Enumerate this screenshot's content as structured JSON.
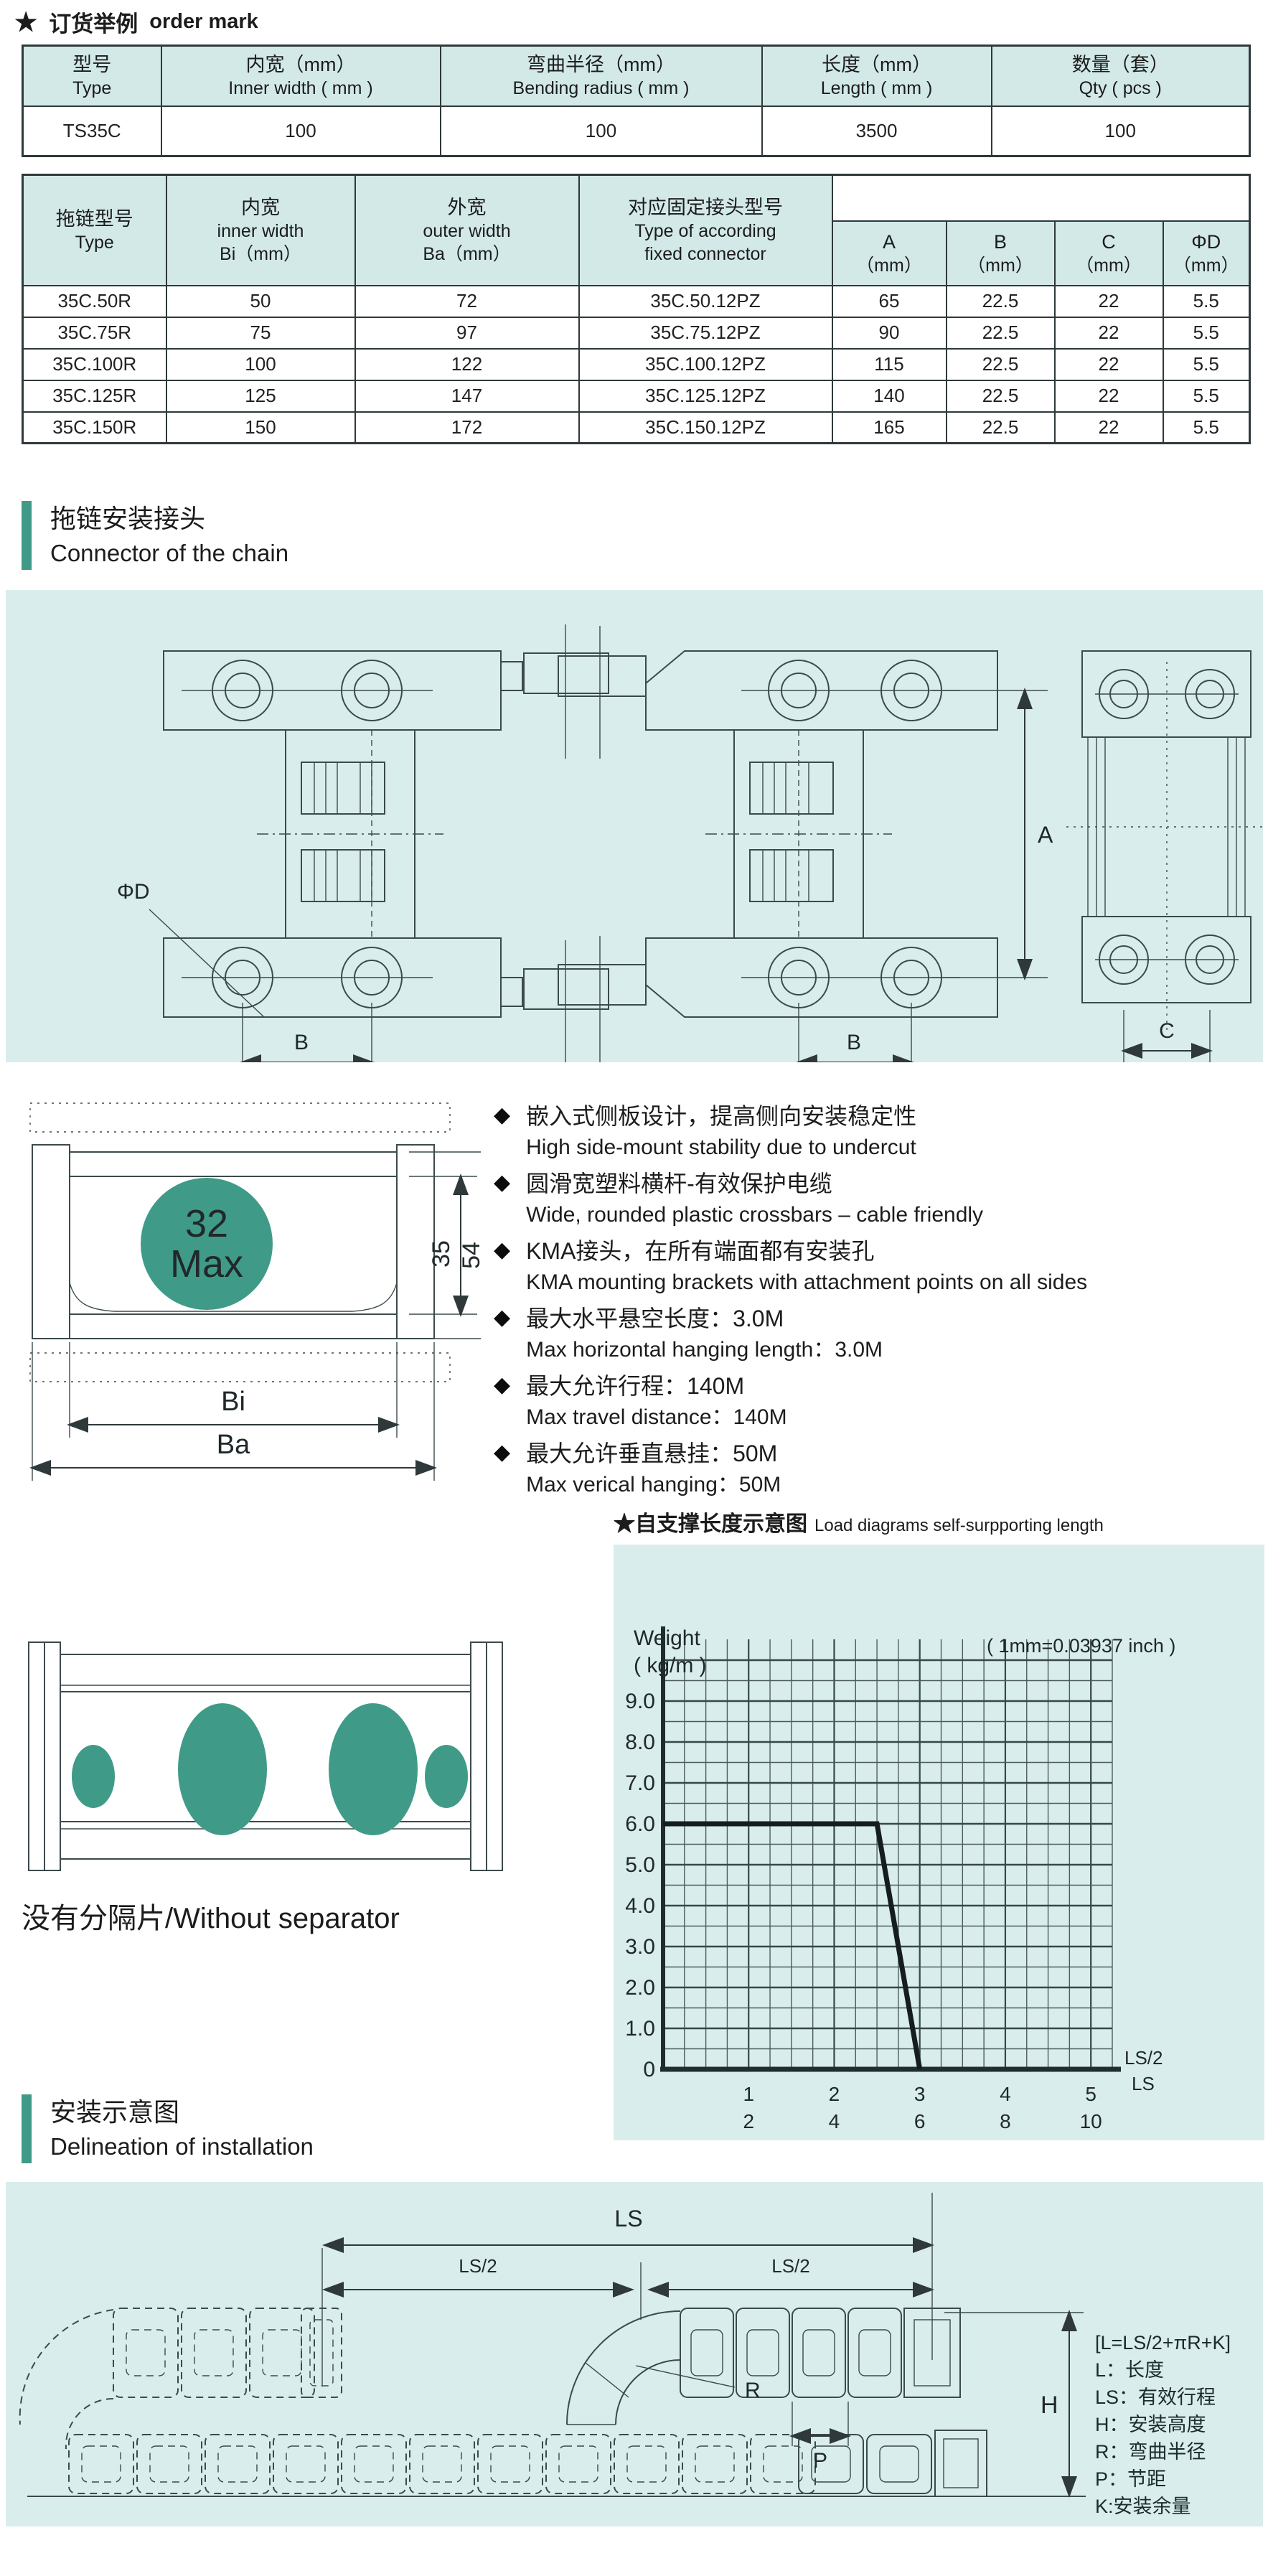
{
  "order": {
    "star": "★",
    "title_zh": "订货举例",
    "title_en": "order mark",
    "headers": [
      {
        "zh": "型号",
        "en": "Type"
      },
      {
        "zh": "内宽（mm）",
        "en": "Inner width ( mm )"
      },
      {
        "zh": "弯曲半径（mm）",
        "en": "Bending radius ( mm )"
      },
      {
        "zh": "长度（mm）",
        "en": "Length ( mm )"
      },
      {
        "zh": "数量（套）",
        "en": "Qty ( pcs )"
      }
    ],
    "rows": [
      [
        "TS35C",
        "100",
        "100",
        "3500",
        "100"
      ]
    ]
  },
  "spec": {
    "col1": {
      "zh": "拖链型号",
      "en": "Type"
    },
    "col2": {
      "zh": "内宽",
      "en": "inner width",
      "sub": "Bi（mm）"
    },
    "col3": {
      "zh": "外宽",
      "en": "outer width",
      "sub": "Ba（mm）"
    },
    "col4": {
      "zh": "对应固定接头型号",
      "en1": "Type of according",
      "en2": "fixed connector"
    },
    "dims": [
      {
        "name": "A",
        "unit": "（mm）"
      },
      {
        "name": "B",
        "unit": "（mm）"
      },
      {
        "name": "C",
        "unit": "（mm）"
      },
      {
        "name": "ΦD",
        "unit": "（mm）"
      }
    ],
    "rows": [
      [
        "35C.50R",
        "50",
        "72",
        "35C.50.12PZ",
        "65",
        "22.5",
        "22",
        "5.5"
      ],
      [
        "35C.75R",
        "75",
        "97",
        "35C.75.12PZ",
        "90",
        "22.5",
        "22",
        "5.5"
      ],
      [
        "35C.100R",
        "100",
        "122",
        "35C.100.12PZ",
        "115",
        "22.5",
        "22",
        "5.5"
      ],
      [
        "35C.125R",
        "125",
        "147",
        "35C.125.12PZ",
        "140",
        "22.5",
        "22",
        "5.5"
      ],
      [
        "35C.150R",
        "150",
        "172",
        "35C.150.12PZ",
        "165",
        "22.5",
        "22",
        "5.5"
      ]
    ]
  },
  "connector": {
    "title_zh": "拖链安装接头",
    "title_en": "Connector of the chain",
    "labels": {
      "phi_d": "ΦD",
      "b_left": "B",
      "a": "A",
      "b_mid": "B",
      "c": "C"
    }
  },
  "cross_section": {
    "circle_top": "32",
    "circle_bottom": "Max",
    "inner_height": "35",
    "outer_height": "54",
    "bi": "Bi",
    "ba": "Ba"
  },
  "features": {
    "items": [
      {
        "zh": "嵌入式侧板设计，提高侧向安装稳定性",
        "en": "High side-mount stability due to undercut"
      },
      {
        "zh": "圆滑宽塑料横杆-有效保护电缆",
        "en": "Wide, rounded plastic crossbars – cable friendly"
      },
      {
        "zh": "KMA接头，在所有端面都有安装孔",
        "en": "KMA mounting brackets with attachment points on all sides"
      },
      {
        "zh": "最大水平悬空长度：3.0M",
        "en": "Max horizontal hanging length：3.0M"
      },
      {
        "zh": "最大允许行程：140M",
        "en": "Max travel distance：140M"
      },
      {
        "zh": "最大允许垂直悬挂：50M",
        "en": "Max verical hanging：50M"
      }
    ],
    "bullet": "◆"
  },
  "chart_header": {
    "star": "★",
    "zh": "自支撑长度示意图",
    "en": "Load diagrams self-surpporting length"
  },
  "chart_data": {
    "type": "line",
    "title": "自支撑长度示意图 / Load diagrams self-surpporting length",
    "ylabel_lines": [
      "Weight",
      "( kg/m )"
    ],
    "note": "( 1mm=0.03937 inch )",
    "x_axis_label_top": "LS/2",
    "x_axis_label_bottom": "LS",
    "x_ticks": [
      {
        "ls2": "1",
        "ls": "2",
        "x": 1
      },
      {
        "ls2": "2",
        "ls": "4",
        "x": 2
      },
      {
        "ls2": "3",
        "ls": "6",
        "x": 3
      },
      {
        "ls2": "4",
        "ls": "8",
        "x": 4
      },
      {
        "ls2": "5",
        "ls": "10",
        "x": 5
      }
    ],
    "x_max": 5.25,
    "x_minor_step": 0.25,
    "y_ticks": [
      0,
      1,
      2,
      3,
      4,
      5,
      6,
      7,
      8,
      9
    ],
    "y_max": 10.25,
    "y_minor_step": 0.5,
    "grid": true,
    "legend_position": "none",
    "series": [
      {
        "name": "self-supporting load limit",
        "points": [
          [
            0,
            6.0
          ],
          [
            2.5,
            6.0
          ],
          [
            3.0,
            0
          ]
        ]
      }
    ]
  },
  "separator": {
    "note": "没有分隔片/Without separator"
  },
  "install": {
    "title_zh": "安装示意图",
    "title_en": "Delineation of installation",
    "labels": {
      "ls": "LS",
      "ls2_left": "LS/2",
      "ls2_right": "LS/2",
      "r": "R",
      "p": "P",
      "h": "H"
    },
    "legend": [
      "[L=LS/2+πR+K]",
      "L：长度",
      "LS：有效行程",
      "H：安装高度",
      "R：弯曲半径",
      "P：节距",
      "K:安装余量"
    ]
  }
}
